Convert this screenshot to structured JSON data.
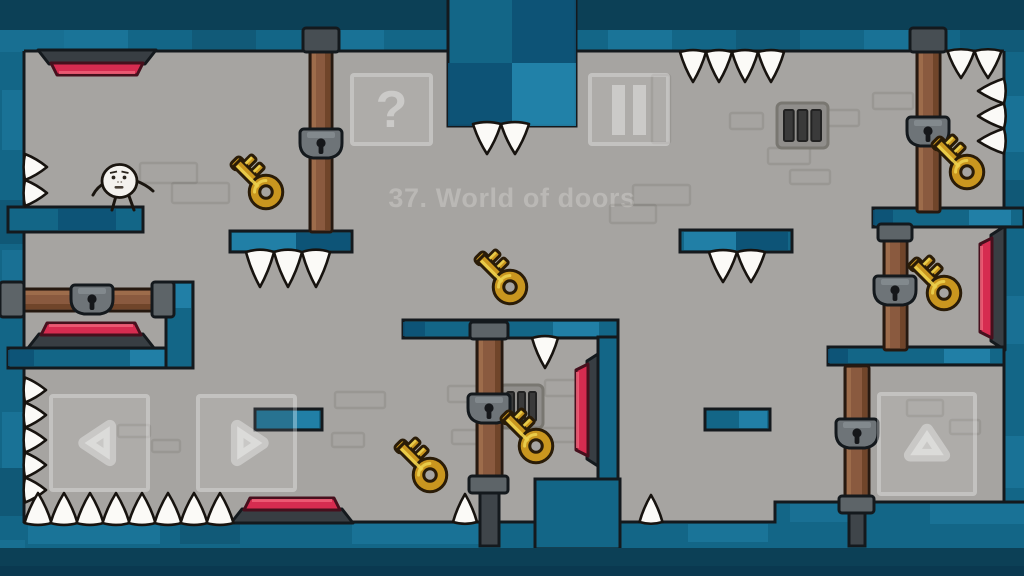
{
  "meta": {
    "width": 1024,
    "height": 576
  },
  "title": {
    "text": "37. World of doors"
  },
  "hud": {
    "help": {
      "label": "?",
      "x": 350,
      "y": 73,
      "w": 83,
      "h": 73
    },
    "pause": {
      "x": 588,
      "y": 73,
      "w": 82,
      "h": 73
    },
    "controls": [
      {
        "id": "move-left",
        "dir": "left",
        "x": 49,
        "y": 394,
        "w": 101,
        "h": 98
      },
      {
        "id": "move-right",
        "dir": "right",
        "x": 196,
        "y": 394,
        "w": 101,
        "h": 98
      },
      {
        "id": "jump",
        "dir": "up",
        "x": 877,
        "y": 392,
        "w": 100,
        "h": 104
      }
    ]
  },
  "palette": {
    "bg": "#a6a4a1",
    "outline": "#14191d",
    "wall_deep": "#0c4056",
    "wall_deep2": "#0a3950",
    "wall_dark": "#0d5174",
    "wall_mid": "#136687",
    "wall_light": "#2484ac",
    "door": "#8a5a3f",
    "door_light": "#a1704f",
    "door_dark": "#6d4328",
    "metal": "#5d6468",
    "metal_dark": "#474e53",
    "metal_post": "#3f454a",
    "key_gold": "#c9961f",
    "key_light": "#ecd04e",
    "key_outline": "#2a1c08",
    "red": "#d62c50",
    "red_dark": "#46101d",
    "red_light": "#ef6078",
    "spike": "#fbfaf7",
    "ui": "rgba(255,255,255,0.34)",
    "title_color": "#bab8b5",
    "brick": "rgba(40,38,34,0.10)"
  },
  "scene": {
    "walls": [
      {
        "x": 0,
        "y": 0,
        "w": 1024,
        "h": 32,
        "tone": "deep"
      },
      {
        "x": 0,
        "y": 30,
        "w": 1024,
        "h": 22,
        "tone": "mid"
      },
      {
        "x": 0,
        "y": 32,
        "w": 25,
        "h": 544,
        "tone": "mid"
      },
      {
        "x": 1004,
        "y": 32,
        "w": 20,
        "h": 544,
        "tone": "mid"
      },
      {
        "x": 0,
        "y": 523,
        "w": 1024,
        "h": 53,
        "tone": "mid"
      },
      {
        "x": 775,
        "y": 503,
        "w": 249,
        "h": 73,
        "tone": "mid"
      }
    ],
    "accents": [
      [
        0,
        30,
        64,
        22,
        "light",
        0.3
      ],
      [
        64,
        30,
        64,
        22,
        "light",
        0.45
      ],
      [
        320,
        30,
        64,
        22,
        "light",
        0.4
      ],
      [
        608,
        30,
        64,
        22,
        "light",
        0.45
      ],
      [
        864,
        30,
        64,
        22,
        "light",
        0.4
      ],
      [
        192,
        30,
        64,
        22,
        "deep",
        0.3
      ],
      [
        736,
        30,
        64,
        22,
        "deep",
        0.3
      ],
      [
        960,
        30,
        64,
        22,
        "deep",
        0.3
      ],
      [
        2,
        90,
        23,
        60,
        "light",
        0.4
      ],
      [
        2,
        250,
        23,
        44,
        "light",
        0.35
      ],
      [
        2,
        412,
        23,
        56,
        "light",
        0.4
      ],
      [
        0,
        200,
        25,
        44,
        "deep",
        0.35
      ],
      [
        0,
        468,
        25,
        48,
        "deep",
        0.35
      ],
      [
        0,
        540,
        25,
        30,
        "light",
        0.3
      ],
      [
        1004,
        96,
        20,
        56,
        "light",
        0.4
      ],
      [
        1004,
        296,
        20,
        48,
        "light",
        0.35
      ],
      [
        1004,
        436,
        20,
        52,
        "light",
        0.4
      ],
      [
        1004,
        180,
        20,
        44,
        "deep",
        0.35
      ],
      [
        28,
        524,
        132,
        20,
        "light",
        0.45
      ],
      [
        352,
        524,
        128,
        20,
        "light",
        0.4
      ],
      [
        688,
        524,
        80,
        18,
        "light",
        0.45
      ],
      [
        180,
        524,
        60,
        20,
        "deep",
        0.3
      ],
      [
        560,
        524,
        58,
        20,
        "deep",
        0.3
      ],
      [
        930,
        504,
        94,
        20,
        "light",
        0.4
      ],
      [
        790,
        504,
        62,
        18,
        "light",
        0.35
      ]
    ],
    "floor_bands": [
      {
        "x": 0,
        "y": 548,
        "w": 1024,
        "h": 28,
        "tone": "deep"
      },
      {
        "x": 0,
        "y": 566,
        "w": 1024,
        "h": 10,
        "tone": "deep2"
      }
    ],
    "outline_paths": [
      "M24,51 H1004",
      "M24,51 V523",
      "M1004,51 V503",
      "M24,522 H775 V502 H1024"
    ],
    "bricks": [
      [
        140,
        163,
        57,
        20
      ],
      [
        172,
        183,
        57,
        20
      ],
      [
        633,
        185,
        57,
        20
      ],
      [
        610,
        205,
        46,
        18
      ],
      [
        730,
        113,
        33,
        16
      ],
      [
        826,
        110,
        33,
        16
      ],
      [
        768,
        148,
        42,
        16
      ],
      [
        790,
        170,
        40,
        14
      ],
      [
        652,
        75,
        18,
        68
      ],
      [
        873,
        93,
        40,
        16
      ],
      [
        448,
        386,
        34,
        16
      ],
      [
        545,
        380,
        34,
        16
      ],
      [
        452,
        430,
        36,
        14
      ],
      [
        538,
        428,
        38,
        14
      ],
      [
        335,
        392,
        50,
        16
      ],
      [
        332,
        433,
        32,
        14
      ],
      [
        118,
        425,
        32,
        12
      ],
      [
        152,
        440,
        28,
        12
      ],
      [
        907,
        400,
        36,
        16
      ],
      [
        950,
        420,
        30,
        14
      ]
    ],
    "vents": [
      {
        "x": 777,
        "y": 103,
        "w": 51,
        "h": 45
      },
      {
        "x": 500,
        "y": 385,
        "w": 43,
        "h": 43
      }
    ],
    "hanging_block": {
      "x": 448,
      "y": -4,
      "w": 128,
      "h": 130,
      "cells": [
        {
          "dx": 64,
          "dy": 0,
          "w": 64,
          "h": 67,
          "tone": "dark"
        },
        {
          "dx": 0,
          "dy": 67,
          "w": 64,
          "h": 63,
          "tone": "dark"
        },
        {
          "dx": 64,
          "dy": 67,
          "w": 64,
          "h": 63,
          "tone": "light"
        }
      ]
    },
    "red_buttons": [
      {
        "dir": "down",
        "x": 38,
        "y": 50,
        "w": 118
      },
      {
        "dir": "up",
        "x": 28,
        "y": 348,
        "w": 126
      },
      {
        "dir": "up",
        "x": 231,
        "y": 523,
        "w": 122
      },
      {
        "dir": "left",
        "x": 601,
        "y": 352,
        "h": 116
      },
      {
        "dir": "left",
        "x": 1005,
        "y": 226,
        "h": 124
      }
    ],
    "platforms": [
      {
        "x": 8,
        "y": 207,
        "w": 135,
        "h": 25,
        "cells": [
          {
            "dx": 50,
            "w": 58,
            "tone": "dark"
          }
        ]
      },
      {
        "x": 230,
        "y": 231,
        "w": 122,
        "h": 21,
        "cells": [
          {
            "dx": 2,
            "w": 64,
            "tone": "light"
          },
          {
            "dx": 66,
            "w": 54,
            "tone": "dark"
          }
        ]
      },
      {
        "x": 680,
        "y": 230,
        "w": 112,
        "h": 22,
        "cells": [
          {
            "dx": 4,
            "w": 52,
            "tone": "light"
          },
          {
            "dx": 56,
            "w": 52,
            "tone": "dark"
          }
        ]
      },
      {
        "x": 873,
        "y": 208,
        "w": 151,
        "h": 19,
        "cells": [
          {
            "dx": 0,
            "w": 20,
            "tone": "dark"
          },
          {
            "dx": 96,
            "w": 42,
            "tone": "light"
          }
        ]
      },
      {
        "x": 403,
        "y": 320,
        "w": 215,
        "h": 18,
        "cells": [
          {
            "dx": 0,
            "w": 22,
            "tone": "dark"
          },
          {
            "dx": 150,
            "w": 46,
            "tone": "light"
          }
        ]
      },
      {
        "x": 8,
        "y": 348,
        "w": 185,
        "h": 20,
        "cells": [
          {
            "dx": 0,
            "w": 26,
            "tone": "dark"
          },
          {
            "dx": 122,
            "w": 46,
            "tone": "light"
          }
        ]
      },
      {
        "x": 166,
        "y": 282,
        "w": 27,
        "h": 86,
        "cells": [
          {
            "dx": 2,
            "w": 23,
            "h": 24,
            "tone": "light"
          }
        ]
      },
      {
        "x": 255,
        "y": 409,
        "w": 67,
        "h": 21,
        "cells": [
          {
            "dx": 38,
            "w": 26,
            "tone": "light"
          }
        ]
      },
      {
        "x": 705,
        "y": 409,
        "w": 65,
        "h": 21,
        "cells": [
          {
            "dx": 34,
            "w": 28,
            "tone": "light"
          }
        ]
      },
      {
        "x": 828,
        "y": 347,
        "w": 176,
        "h": 18,
        "cells": [
          {
            "dx": 0,
            "w": 20,
            "tone": "dark"
          },
          {
            "dx": 116,
            "w": 46,
            "tone": "light"
          }
        ]
      },
      {
        "x": 598,
        "y": 337,
        "w": 20,
        "h": 146
      },
      {
        "x": 535,
        "y": 479,
        "w": 85,
        "h": 70
      }
    ],
    "doors": [
      {
        "dir": "v",
        "x": 310,
        "y": 48,
        "w": 22,
        "h": 184,
        "caps": [
          {
            "x": 303,
            "y": 28,
            "w": 36,
            "h": 24,
            "dark": true
          }
        ],
        "lock": {
          "x": 321,
          "y": 144
        }
      },
      {
        "dir": "v",
        "x": 917,
        "y": 48,
        "w": 23,
        "h": 164,
        "caps": [
          {
            "x": 910,
            "y": 28,
            "w": 36,
            "h": 24,
            "dark": true
          }
        ],
        "lock": {
          "x": 928,
          "y": 132
        }
      },
      {
        "dir": "v",
        "x": 884,
        "y": 238,
        "w": 23,
        "h": 112,
        "caps": [
          {
            "x": 878,
            "y": 224,
            "w": 34,
            "h": 17
          }
        ],
        "lock": {
          "x": 895,
          "y": 291
        }
      },
      {
        "dir": "v",
        "x": 845,
        "y": 366,
        "w": 24,
        "h": 134,
        "caps": [
          {
            "x": 839,
            "y": 496,
            "w": 35,
            "h": 17
          }
        ],
        "lock": {
          "x": 857,
          "y": 434
        },
        "post": {
          "x": 849,
          "y": 508,
          "w": 16,
          "h": 38
        }
      },
      {
        "dir": "v",
        "x": 477,
        "y": 337,
        "w": 25,
        "h": 142,
        "caps": [
          {
            "x": 470,
            "y": 322,
            "w": 38,
            "h": 17
          },
          {
            "x": 469,
            "y": 476,
            "w": 39,
            "h": 17
          }
        ],
        "lock": {
          "x": 489,
          "y": 409
        },
        "post": {
          "x": 480,
          "y": 490,
          "w": 19,
          "h": 56
        }
      },
      {
        "dir": "h",
        "x": 22,
        "y": 289,
        "w": 140,
        "h": 22,
        "caps": [
          {
            "x": 0,
            "y": 282,
            "w": 24,
            "h": 35
          },
          {
            "x": 152,
            "y": 282,
            "w": 22,
            "h": 35
          }
        ],
        "lock": {
          "x": 92,
          "y": 300
        }
      }
    ],
    "spikes": [
      {
        "dir": "down",
        "x": 693,
        "y": 52,
        "n": 4,
        "step": 26,
        "w": 26,
        "len": 30
      },
      {
        "dir": "down",
        "x": 961,
        "y": 51,
        "n": 2,
        "step": 27,
        "w": 27,
        "len": 27
      },
      {
        "dir": "left",
        "x": 1004,
        "y": 91,
        "n": 3,
        "step": 25,
        "w": 25,
        "len": 26
      },
      {
        "dir": "right",
        "x": 25,
        "y": 167,
        "n": 2,
        "step": 26,
        "w": 26,
        "len": 22
      },
      {
        "dir": "right",
        "x": 25,
        "y": 390,
        "n": 5,
        "step": 25,
        "w": 25,
        "len": 21
      },
      {
        "dir": "up",
        "x": 38,
        "y": 523,
        "n": 8,
        "step": 26,
        "w": 27,
        "len": 30
      },
      {
        "dir": "up",
        "x": 465,
        "y": 522,
        "n": 1,
        "w": 24,
        "len": 28
      },
      {
        "dir": "up",
        "x": 651,
        "y": 522,
        "n": 1,
        "w": 23,
        "len": 27
      },
      {
        "dir": "down",
        "x": 260,
        "y": 252,
        "n": 3,
        "step": 28,
        "w": 28,
        "len": 35
      },
      {
        "dir": "down",
        "x": 723,
        "y": 252,
        "n": 2,
        "step": 28,
        "w": 28,
        "len": 30
      },
      {
        "dir": "down",
        "x": 487,
        "y": 124,
        "n": 2,
        "step": 28,
        "w": 28,
        "len": 30
      },
      {
        "dir": "down",
        "x": 545,
        "y": 338,
        "n": 1,
        "w": 26,
        "len": 30
      }
    ],
    "keys": [
      {
        "x": 266,
        "y": 192
      },
      {
        "x": 510,
        "y": 287
      },
      {
        "x": 967,
        "y": 172
      },
      {
        "x": 944,
        "y": 293
      },
      {
        "x": 536,
        "y": 446
      },
      {
        "x": 430,
        "y": 475
      }
    ],
    "character": {
      "x": 119.5,
      "y": 181
    }
  }
}
